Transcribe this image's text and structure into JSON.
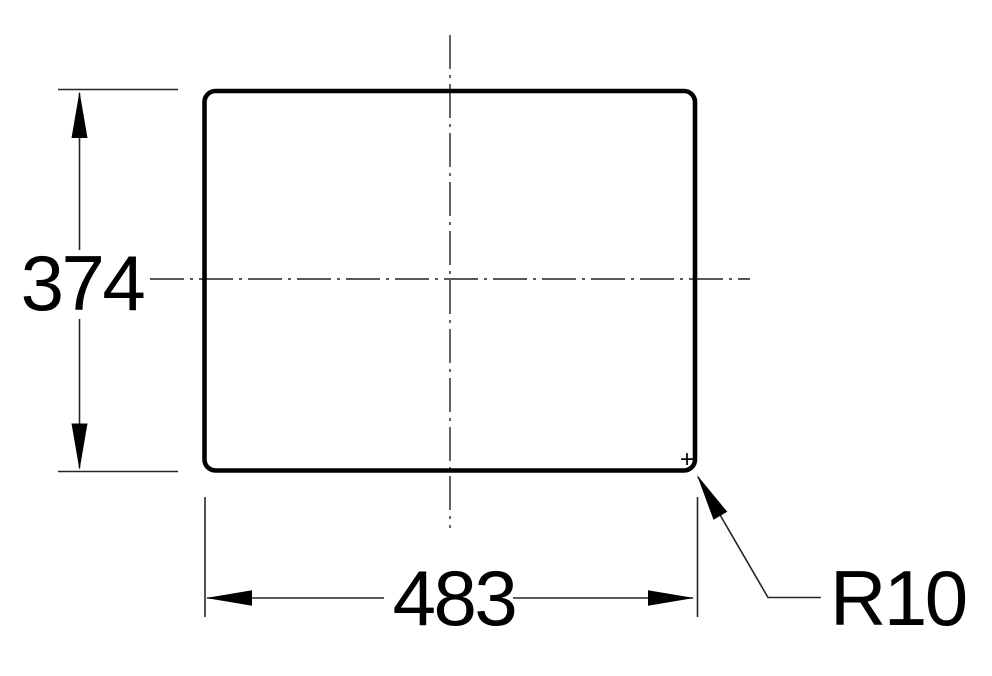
{
  "drawing": {
    "type": "technical-dimension-drawing",
    "background_color": "#ffffff",
    "outline_color": "#000000",
    "thin_line_color": "#262626",
    "labels": {
      "height": "374",
      "width": "483",
      "corner_radius": "R10",
      "radius_center_mark": "+"
    }
  }
}
